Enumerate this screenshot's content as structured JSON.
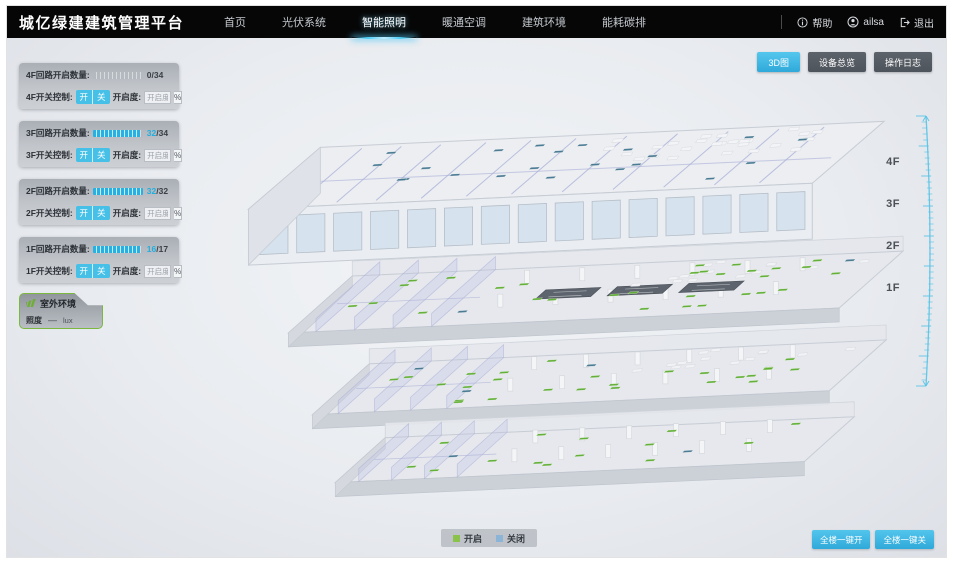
{
  "header": {
    "title": "城亿绿建建筑管理平台",
    "nav": [
      {
        "label": "首页",
        "active": false
      },
      {
        "label": "光伏系统",
        "active": false
      },
      {
        "label": "智能照明",
        "active": true
      },
      {
        "label": "暖通空调",
        "active": false
      },
      {
        "label": "建筑环境",
        "active": false
      },
      {
        "label": "能耗碳排",
        "active": false
      }
    ],
    "help": "帮助",
    "user": "ailsa",
    "logout": "退出"
  },
  "toolbar": {
    "buttons": [
      {
        "label": "3D图",
        "active": true
      },
      {
        "label": "设备总览",
        "active": false
      },
      {
        "label": "操作日志",
        "active": false
      }
    ]
  },
  "floor_panels": [
    {
      "floor": "4F",
      "circuit_label": "4F回路开启数量:",
      "on_count": "0",
      "total": "/34",
      "on_color": "#3a4046",
      "ratio": 0,
      "switch_label": "4F开关控制:",
      "btn_on": "开",
      "btn_off": "关",
      "openness_label": "开启度:",
      "openness_placeholder": "开启度",
      "percent_label": "%"
    },
    {
      "floor": "3F",
      "circuit_label": "3F回路开启数量:",
      "on_count": "32",
      "total": "/34",
      "on_color": "#23aede",
      "ratio": 0.94,
      "switch_label": "3F开关控制:",
      "btn_on": "开",
      "btn_off": "关",
      "openness_label": "开启度:",
      "openness_placeholder": "开启度",
      "percent_label": "%"
    },
    {
      "floor": "2F",
      "circuit_label": "2F回路开启数量:",
      "on_count": "32",
      "total": "/32",
      "on_color": "#23aede",
      "ratio": 1,
      "switch_label": "2F开关控制:",
      "btn_on": "开",
      "btn_off": "关",
      "openness_label": "开启度:",
      "openness_placeholder": "开启度",
      "percent_label": "%"
    },
    {
      "floor": "1F",
      "circuit_label": "1F回路开启数量:",
      "on_count": "16",
      "total": "/17",
      "on_color": "#23aede",
      "ratio": 0.94,
      "switch_label": "1F开关控制:",
      "btn_on": "开",
      "btn_off": "关",
      "openness_label": "开启度:",
      "openness_placeholder": "开启度",
      "percent_label": "%"
    }
  ],
  "outdoor_panel": {
    "title": "室外环境",
    "metric_label": "照度",
    "metric_value": "—",
    "metric_unit": "lux"
  },
  "scene": {
    "floor_labels": [
      "4F",
      "3F",
      "2F",
      "1F"
    ]
  },
  "legend": {
    "on_label": "开启",
    "off_label": "关闭"
  },
  "bulk_actions": {
    "all_on": "全楼一键开",
    "all_off": "全楼一键关"
  },
  "colors": {
    "accent": "#3db6e4",
    "legend_on": "#8bc34a",
    "legend_off": "#8cb4d6",
    "marker_on": "#5fae32",
    "marker_off": "#44768f",
    "ruler": "#56c3e7"
  }
}
